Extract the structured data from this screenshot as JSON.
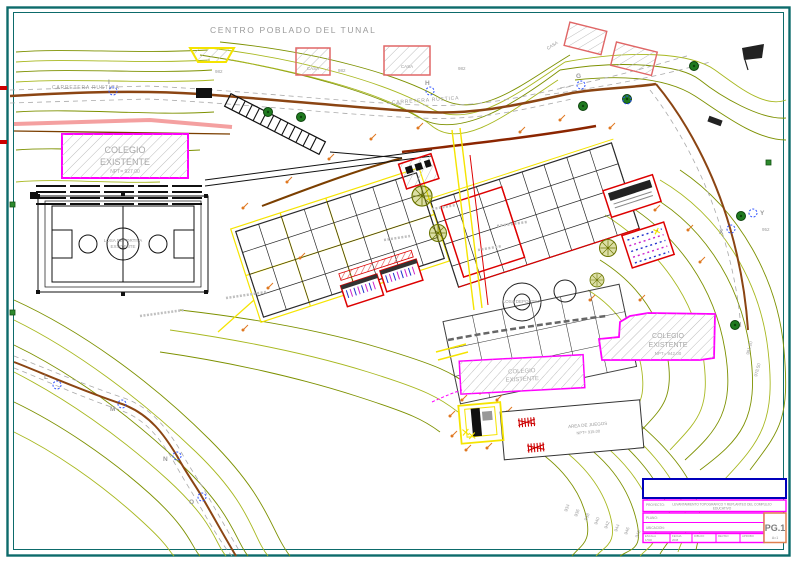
{
  "drawing": {
    "title": "CENTRO POBLADO DEL TUNAL",
    "road_label_1": "CARRETERA RUSTICA",
    "road_label_2": "CARRETERA RUSTICA",
    "casa_label": "CASA",
    "colegio_left": {
      "line1": "COLEGIO",
      "line2": "EXISTENTE",
      "line3": "NPT= 927.00"
    },
    "colegio_right": {
      "line1": "COLEGIO",
      "line2": "EXISTENTE",
      "line3": "NPT= 942.00"
    },
    "colegio_bottom": {
      "line1": "COLEGIO",
      "line2": "EXISTENTE"
    },
    "court_left": {
      "line1": "LOSA DEPORTIVA",
      "line2": "EXISTENTE"
    },
    "court_center_label": "LOSA DEPORTIVA",
    "juegos": {
      "line1": "AREA DE JUEGOS",
      "line2": "NPT= 915.00"
    },
    "survey_points": [
      "I",
      "H",
      "G",
      "X",
      "Y",
      "L",
      "M",
      "N",
      "O"
    ],
    "elevations_top": [
      "982",
      "982",
      "982"
    ],
    "elevation_right": "952",
    "contour_labels": [
      "934",
      "936",
      "938",
      "940",
      "942",
      "944",
      "946",
      "948"
    ],
    "slope_labels": [
      "981.20",
      "978.50"
    ]
  },
  "titleblock": {
    "project_label": "PROYECTO:",
    "project_line1": "LEVANTAMIENTO TOPOGRAFICO Y REPLANTEO DEL COMPLEJO",
    "project_line2": "EDUCATIVO",
    "plano_label": "PLANO:",
    "ubicacion_label": "UBICACION:",
    "cells": [
      {
        "label": "ESCALA",
        "value": "1/500"
      },
      {
        "label": "FECHA",
        "value": "2008"
      },
      {
        "label": "DIBUJO",
        "value": ""
      },
      {
        "label": "REVISO",
        "value": ""
      },
      {
        "label": "APROBO",
        "value": ""
      }
    ],
    "sheet": "PG.1",
    "sheet_sub": "A=1"
  },
  "colors": {
    "frame": "#0d6b6b",
    "contour_olive": "#7d9100",
    "contour_light": "#a8b820",
    "road_brown": "#8b4513",
    "magenta": "#ff00ff",
    "red": "#dd0000",
    "yellow": "#f5e400",
    "orange_marker": "#e07820",
    "pink_band": "#f4a0a0",
    "blue_marker": "#2b50ff",
    "gray_text": "#9a9a9a",
    "titleblock_blue": "#0000bb",
    "titleblock_orange": "#e08050"
  }
}
